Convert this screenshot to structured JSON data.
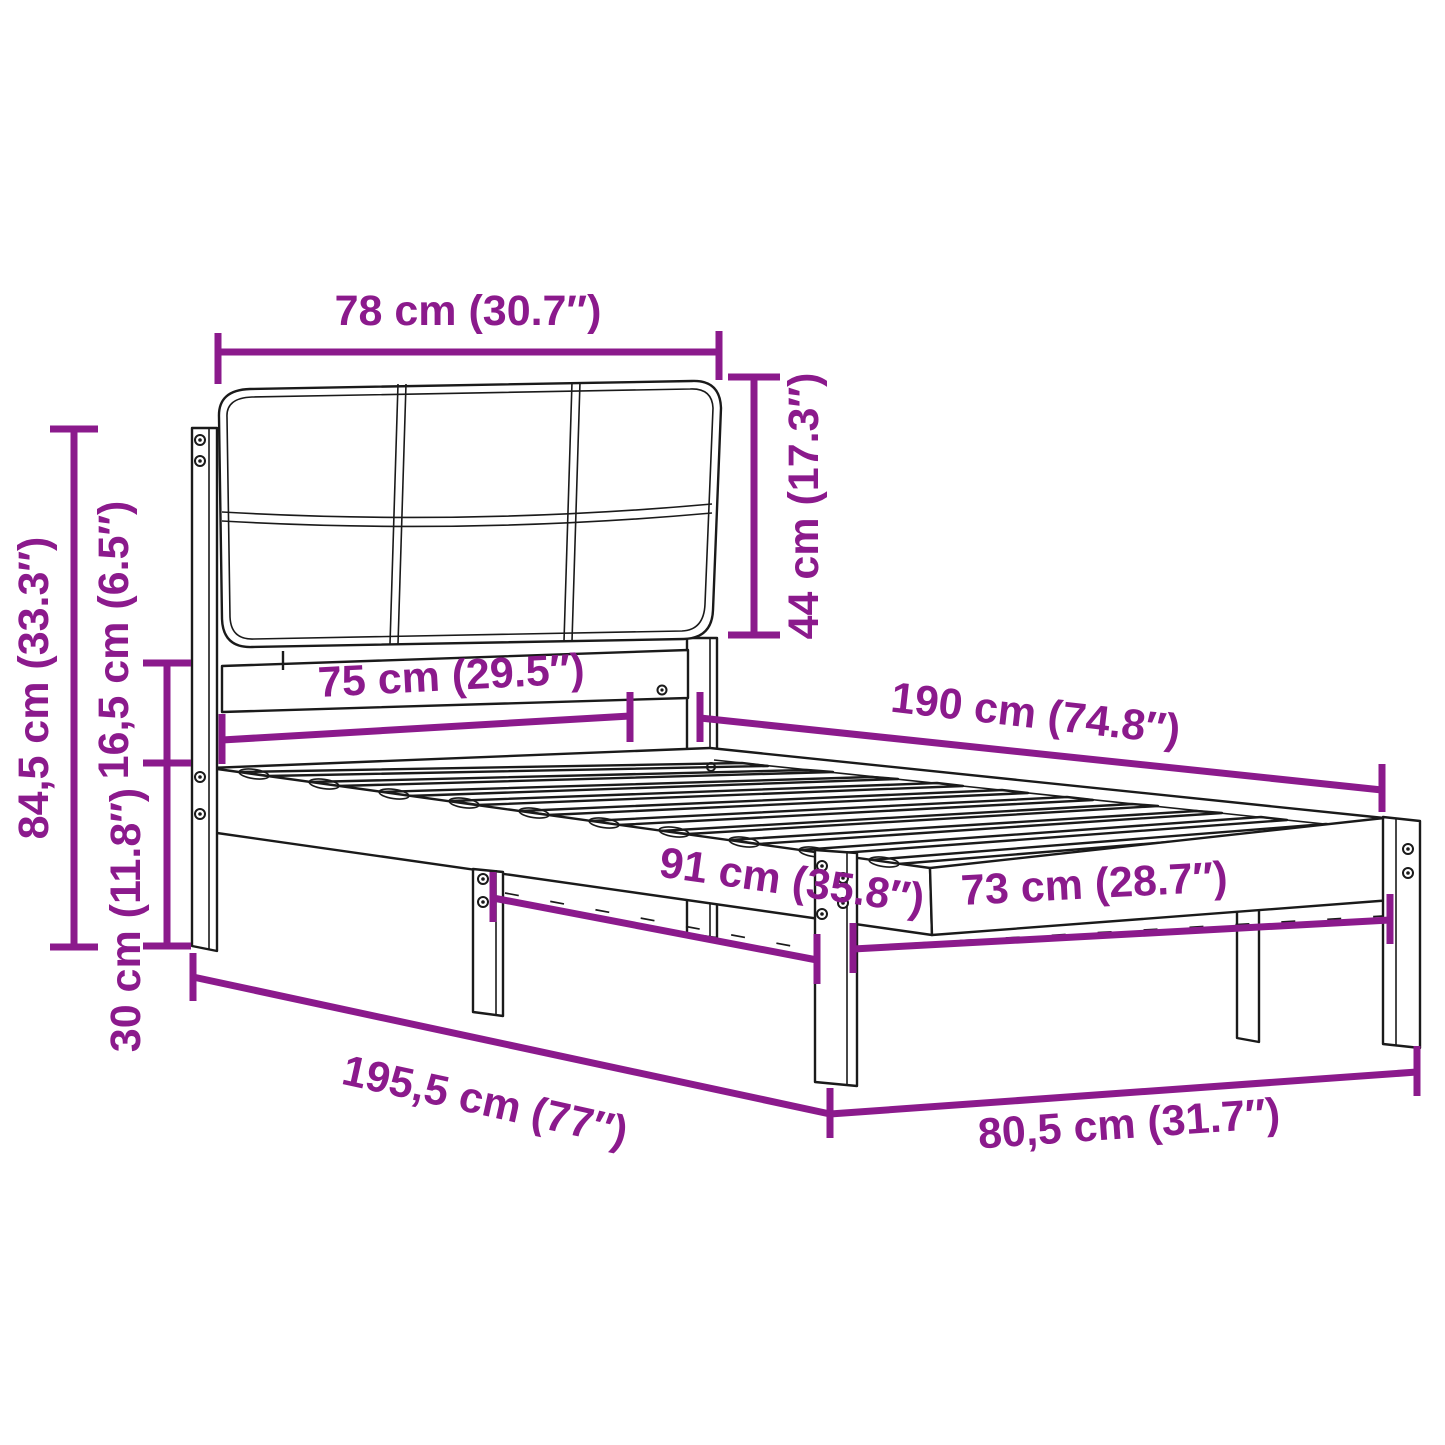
{
  "diagram": {
    "type": "furniture-dimension-diagram",
    "subject": "bed frame with upholstered headboard and slatted base",
    "units": [
      "cm",
      "inches"
    ],
    "colors": {
      "accent": "#8B1A8C",
      "line": "#1a1a1a",
      "background": "#ffffff"
    },
    "dims": {
      "headboard_width": {
        "label": "78 cm (30.7″)",
        "cm": "78",
        "inch": "30.7"
      },
      "headboard_height": {
        "label": "44 cm (17.3″)",
        "cm": "44",
        "inch": "17.3"
      },
      "total_height": {
        "label": "84,5 cm (33.3″)",
        "cm": "84,5",
        "inch": "33.3"
      },
      "rail_height": {
        "label": "16,5 cm (6.5″)",
        "cm": "16,5",
        "inch": "6.5"
      },
      "leg_height": {
        "label": "30 cm (11.8″)",
        "cm": "30",
        "inch": "11.8"
      },
      "headboard_inner_width": {
        "label": "75 cm (29.5″)",
        "cm": "75",
        "inch": "29.5"
      },
      "bed_length": {
        "label": "190 cm (74.8″)",
        "cm": "190",
        "inch": "74.8"
      },
      "leg_span_length": {
        "label": "91 cm (35.8″)",
        "cm": "91",
        "inch": "35.8"
      },
      "leg_span_width": {
        "label": "73 cm (28.7″)",
        "cm": "73",
        "inch": "28.7"
      },
      "total_length": {
        "label": "195,5 cm (77″)",
        "cm": "195,5",
        "inch": "77"
      },
      "total_width": {
        "label": "80,5 cm (31.7″)",
        "cm": "80,5",
        "inch": "31.7"
      }
    }
  }
}
